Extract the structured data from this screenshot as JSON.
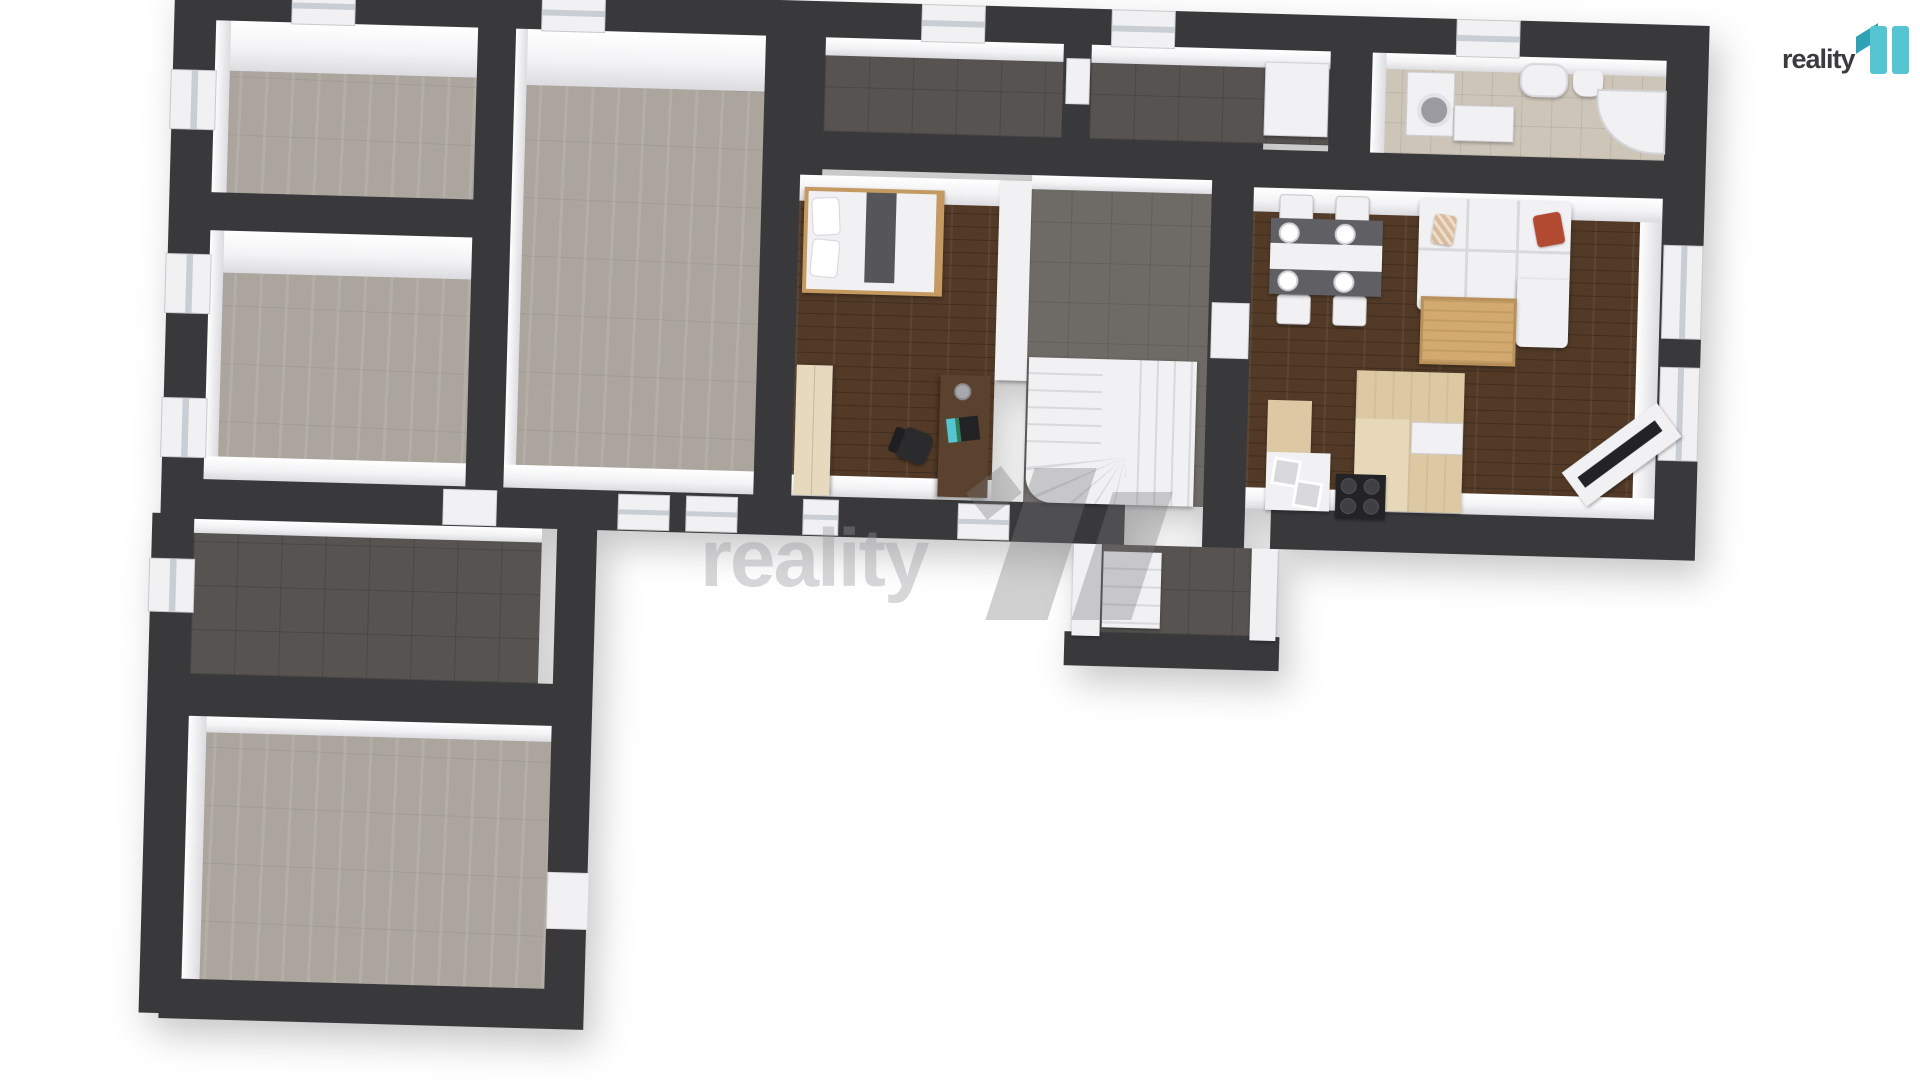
{
  "logo": {
    "brand": "reality",
    "brand_suffix": "11"
  },
  "watermark": {
    "text": "reality",
    "suffix": "11"
  },
  "colors": {
    "wall": "#39393b",
    "face": "#f3f3f5",
    "face-shadow": "#dcdce0",
    "concrete": "#aba59e",
    "tile-dark": "#565350",
    "tile-hall": "#6e6a66",
    "wood": "#523a27",
    "light-wood": "#d2a96e",
    "pale-wood": "#dcc9a4",
    "wardrobe-wood": "#e6d9bd",
    "desk-wood": "#5b422e",
    "frame-wood": "#c49a62",
    "bath-tile": "#cdc5b8",
    "white-item": "#f1f1f3",
    "sofa-shadow": "#d8d8dd",
    "table-dark": "#5f5f64",
    "runner-dark": "#55555a",
    "pillow-red": "#b14a31",
    "pillow-beige": "#d9bb9b",
    "black-item": "#232325",
    "glass": "#c9ced4",
    "teal": "#55c5d1",
    "teal-dark": "#2fa3b6",
    "logo-text": "#3b3b3d",
    "watermark-ink": "rgba(150,150,155,0.38)",
    "watermark-block": "rgba(120,120,124,0.35)"
  },
  "floorplan": {
    "style": "3d-top-down-render",
    "rooms": [
      {
        "name": "empty-room-top-left",
        "floor": "concrete",
        "furniture": []
      },
      {
        "name": "empty-room-left",
        "floor": "concrete",
        "furniture": []
      },
      {
        "name": "large-empty-room",
        "floor": "concrete",
        "furniture": []
      },
      {
        "name": "bedroom",
        "floor": "dark-wood",
        "furniture": [
          "bed",
          "wardrobe",
          "desk",
          "office-chair",
          "laptop",
          "desk-lamp"
        ]
      },
      {
        "name": "stair-hall",
        "floor": "dark-tile",
        "furniture": [
          "winder-staircase"
        ]
      },
      {
        "name": "corridor-left",
        "floor": "dark-tile",
        "furniture": []
      },
      {
        "name": "corridor-right",
        "floor": "dark-tile",
        "furniture": [
          "closet"
        ]
      },
      {
        "name": "bathroom",
        "floor": "beige-tile",
        "furniture": [
          "washing-machine",
          "vanity-counter",
          "wash-basin",
          "toilet",
          "corner-shower"
        ]
      },
      {
        "name": "kitchen-living-room",
        "floor": "dark-wood",
        "furniture": [
          "dining-table",
          "dining-chairs",
          "plates",
          "corner-sofa",
          "beige-pillow",
          "red-pillow",
          "coffee-table",
          "tv-on-stand",
          "kitchen-island",
          "double-sink",
          "cooktop"
        ]
      },
      {
        "name": "entry-vestibule",
        "floor": "dark-tile",
        "furniture": [
          "entry-steps"
        ]
      },
      {
        "name": "lower-hallway",
        "floor": "dark-tile",
        "furniture": []
      },
      {
        "name": "large-room-garage",
        "floor": "concrete",
        "furniture": []
      }
    ]
  }
}
